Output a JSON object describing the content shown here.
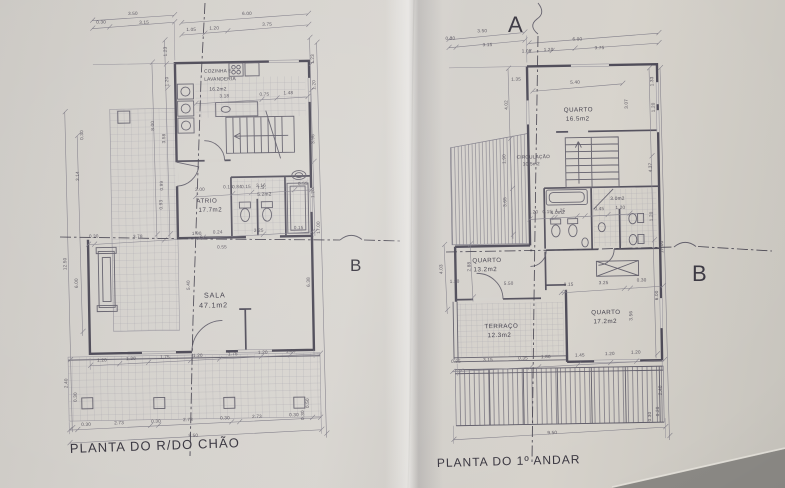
{
  "colors": {
    "paper": "#d4d1cc",
    "ink": "#4a4754",
    "dim_ink": "#534f5a",
    "shadow": "#8b8985"
  },
  "markers": {
    "section_a": "A",
    "section_b_left": "B",
    "section_b_right": "B"
  },
  "ground_floor": {
    "title": "PLANTA DO R/DO CHÃO",
    "rooms": {
      "kitchen_name_line1": "COZINHA E",
      "kitchen_name_line2": "LAVANDERIA",
      "kitchen_area": "16.2m2",
      "atrium_name": "ATRIO",
      "atrium_area": "17.7m2",
      "wc_name": "I.S.",
      "wc_area": "5.2m2",
      "living_name": "SALA",
      "living_area": "47.1m2"
    },
    "dims_top": [
      "3.50",
      "0.30",
      "3.15",
      "6.00",
      "1.05",
      "1.20",
      "3.75"
    ],
    "dims_kitchen": [
      "3.18",
      "0.75",
      "1.48"
    ],
    "dims_left": [
      "1.23",
      "1.20",
      "8.00",
      "3.58",
      "0.30",
      "3.14",
      "0.99",
      "0.93",
      "12.50",
      "6.00",
      "2.40",
      "0.30"
    ],
    "dims_mid": [
      "2.00",
      "0.15",
      "0.84",
      "0.15",
      "2.16",
      "0.55"
    ],
    "dims_sala_top": [
      "0.30",
      "3.78",
      "1.90",
      "0.24",
      "3.25",
      "0.15",
      "0.55"
    ],
    "dims_center": [
      "5.40",
      "6.38"
    ],
    "dims_right": [
      "1.23",
      "1.20",
      "3.96",
      "1.20",
      "17.00",
      "0.50",
      "0.30"
    ],
    "dims_windows": [
      "1.20",
      "1.20",
      "1.75",
      "1.20",
      "1.75",
      "1.20",
      "1.20"
    ],
    "dims_footer": [
      "0.30",
      "2.73",
      "0.30",
      "2.73",
      "0.30",
      "2.73",
      "0.30"
    ],
    "dim_total": "9.50"
  },
  "first_floor": {
    "title": "PLANTA DO 1º ANDAR",
    "rooms": {
      "bedroom1_name": "QUARTO",
      "bedroom1_area": "16.5m2",
      "circulation_name": "CIRCULAÇÃO",
      "circulation_area": "10.5m2",
      "bathroom1_area": "4.0m2",
      "bathroom2_area": "3.0m2",
      "bedroom2_name": "QUARTO",
      "bedroom2_area": "13.2m2",
      "terrace_name": "TERRAÇO",
      "terrace_area": "12.3m2",
      "bedroom3_name": "QUARTO",
      "bedroom3_area": "17.2m2"
    },
    "dims_top": [
      "3.50",
      "0.30",
      "3.15",
      "6.00",
      "1.05",
      "1.20",
      "3.75"
    ],
    "dims_upper": [
      "5.40",
      "1.35",
      "3.07",
      "1.33",
      "1.20"
    ],
    "dims_left": [
      "4.02",
      "1.90",
      "3.65",
      "4.03",
      "2.88",
      "1.30",
      "5.50"
    ],
    "dims_bath": [
      "1.20",
      "0.15",
      "1.25",
      "0.45",
      "1.20"
    ],
    "dims_mid": [
      "0.15",
      "3.25",
      "0.30"
    ],
    "dims_right": [
      "4.37",
      "1.20",
      "17.00",
      "6.00",
      "3.56"
    ],
    "dims_bottom": [
      "0.35",
      "3.15",
      "0.35",
      "1.80",
      "1.45",
      "1.20",
      "1.20"
    ],
    "dims_footer": [
      "2.40",
      "0.20",
      "0.30"
    ],
    "dim_total": "9.50"
  }
}
